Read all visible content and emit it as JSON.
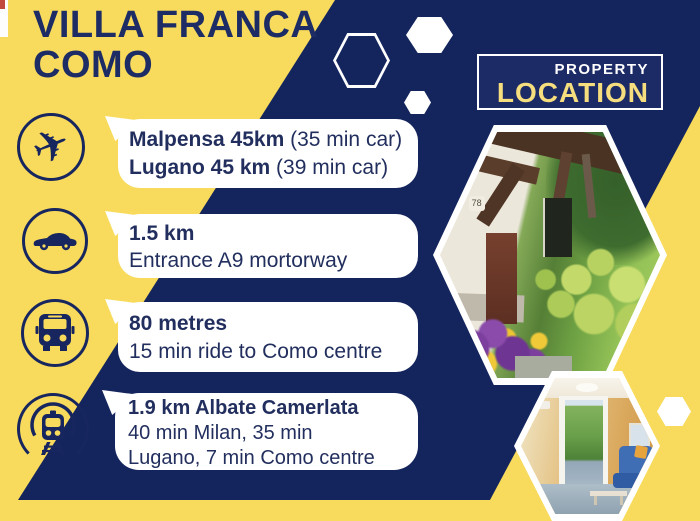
{
  "colors": {
    "yellow": "#F8DB5C",
    "navy": "#14255E",
    "text_navy": "#222F5E",
    "badge_yellow": "#F6DD7D",
    "white": "#FFFFFF"
  },
  "title": {
    "line1": "VILLA FRANCA",
    "line2": "COMO"
  },
  "badge": {
    "top": "PROPERTY",
    "bottom": "LOCATION"
  },
  "rows": [
    {
      "icon": "plane-icon",
      "line1_bold": "Malpensa 45km",
      "line1_rest": " (35 min car)",
      "line2_bold": "Lugano 45 km",
      "line2_rest": " (39 min car)"
    },
    {
      "icon": "car-icon",
      "line1_bold": "1.5 km",
      "line2_rest": "Entrance A9 mortorway"
    },
    {
      "icon": "bus-icon",
      "line1_bold": "80 metres",
      "line2_rest": "15 min ride to Como centre"
    },
    {
      "icon": "train-icon",
      "line1_bold": "1.9 km Albate Camerlata",
      "line2_rest": "40 min Milan, 35 min",
      "line3_rest": "Lugano, 7 min Como centre"
    }
  ],
  "icons": {
    "plane_glyph": "✈"
  },
  "photos": [
    {
      "name": "house-exterior",
      "house_number": "78"
    },
    {
      "name": "living-room"
    }
  ]
}
